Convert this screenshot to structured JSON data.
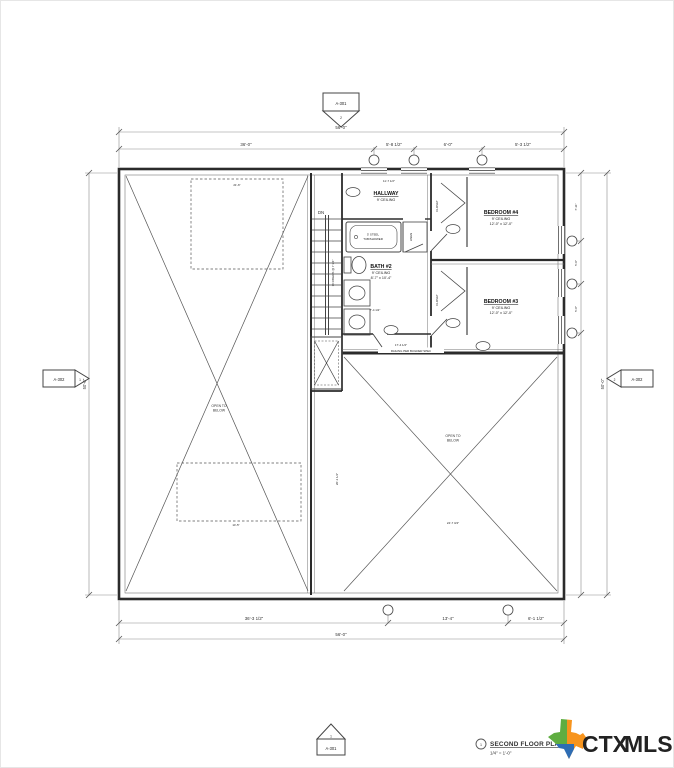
{
  "drawing": {
    "title_block": {
      "number": "1",
      "title": "SECOND FLOOR PLAN",
      "scale": "1/4\" = 1'-0\""
    },
    "logo": {
      "ctx": "CTX",
      "mls": "MLS",
      "ctx_color": "#F5821F",
      "mls_color": "#1B75BB",
      "texas_green": "#5FAD41",
      "texas_orange": "#F7941D",
      "texas_blue": "#2E6DB4"
    },
    "section_markers": {
      "top": {
        "sheet": "A-301",
        "detail": "2"
      },
      "bottom": {
        "sheet": "A-301",
        "detail": "1"
      },
      "left": {
        "sheet": "A-302",
        "detail": "1"
      },
      "right": {
        "sheet": "A-302",
        "detail": "2"
      }
    },
    "rooms": {
      "hallway": {
        "name": "HALLWAY",
        "ceiling": "9' CEILING"
      },
      "bath2": {
        "name": "BATH #2",
        "ceiling": "9' CEILING",
        "size": "8'-7\" x 10'-4\""
      },
      "bedroom4": {
        "name": "BEDROOM #4",
        "ceiling": "9' CEILING",
        "size": "12'-0\" x 12'-0\""
      },
      "bedroom3": {
        "name": "BEDROOM #3",
        "ceiling": "9' CEILING",
        "size": "12'-0\" x 12'-0\""
      },
      "open_left": {
        "line1": "OPEN TO",
        "line2": "BELOW"
      },
      "open_right": {
        "line1": "OPEN TO",
        "line2": "BELOW"
      }
    },
    "annotations": {
      "stairs_dn": "DN",
      "stairs_risers": "16 RISERS @ 7 3/4\"",
      "railing": "RAILING PER BUILDER SPEC",
      "tub_line1": "5' STEEL",
      "tub_line2": "TUB/SHOWER",
      "linen": "LINEN",
      "closet4": "CLOSET",
      "closet3": "CLOSET"
    },
    "dimensions": {
      "top_overall": "56'-0\"",
      "top_segments": [
        "36'-0\"",
        "5'-8 1/2\"",
        "6'-0\"",
        "5'-3 1/2\""
      ],
      "bottom_segments": [
        "36'-3 1/2\"",
        "13'-4\"",
        "6'-1 1/2\""
      ],
      "bottom_overall": "56'-0\"",
      "left_overall": "50'-0\"",
      "right_overall": "50'-0\"",
      "right_segments": [
        "7'-11\"",
        "5'-0\"",
        "5'-8\""
      ],
      "interior": [
        "11'-7 1/2\"",
        "21'-6\"",
        "7'-4 1/2\"",
        "17'-4 1/2\"",
        "24'-7 3/4\"",
        "14'-5\"",
        "20'-1 1/2\""
      ]
    }
  }
}
